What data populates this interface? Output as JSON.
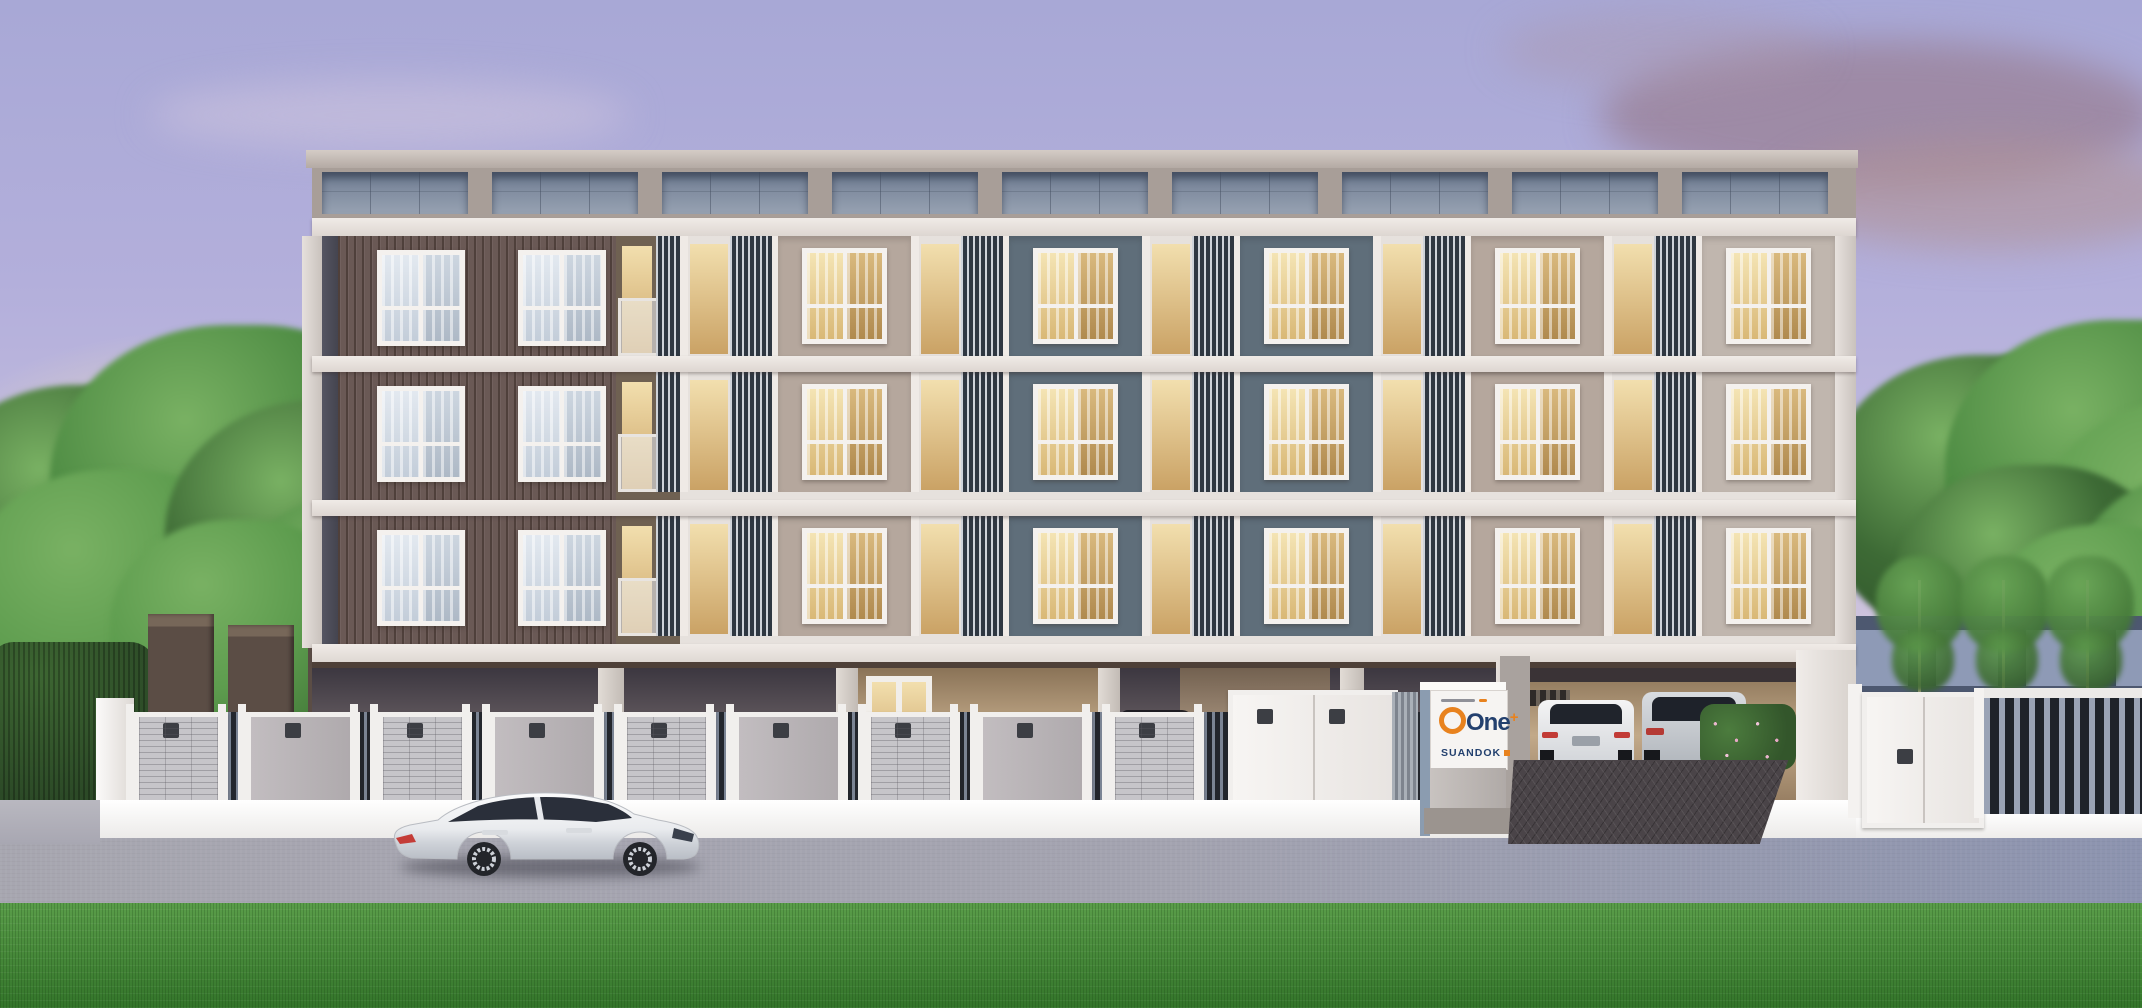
{
  "scene": {
    "title": "dusk-rendering-of-low-rise-condominium",
    "time_of_day": "dusk",
    "sign": {
      "brand": "One",
      "plus": "+",
      "subtitle": "SUANDOK"
    },
    "building": {
      "floors": 3,
      "left_wing_style": "brown ribbed siding",
      "center_bays": 5,
      "windows_lit": true
    },
    "street_vehicle": "white luxury sedan",
    "colors": {
      "sky_top": "#a8a8d6",
      "sky_horizon": "#ecdfd2",
      "sunset_glow": "#f6e7bf",
      "cloud_mauve": "#9b8293",
      "tree_green": "#44823a",
      "grass": "#47923a",
      "wing_brown": "#6a5955",
      "panel_beige": "#b5a79d",
      "panel_slate": "#5f6e7a",
      "panel_greige": "#c0b6ae",
      "beam_white": "#e9e4e0",
      "window_glow": "#ecd39c",
      "parapet_panel": "#8694a6",
      "fence_grey": "#c6c5c9",
      "road_grey": "#a2a2ae",
      "sign_orange": "#e8821e",
      "sign_navy": "#23406e",
      "driveway_paver": "#4a4448"
    }
  },
  "layout": {
    "parapet": {
      "count": 9,
      "x0": 322,
      "pitch": 170,
      "w": 146,
      "y": 172,
      "h": 42
    },
    "floors": [
      {
        "top": 236
      },
      {
        "top": 372
      },
      {
        "top": 516
      }
    ],
    "wing_windows_x": [
      377,
      518
    ],
    "bays": [
      {
        "x": 680,
        "panel": "#b5a79d"
      },
      {
        "x": 911,
        "panel": "#5f6e7a"
      },
      {
        "x": 1142,
        "panel": "#5f6e7a"
      },
      {
        "x": 1373,
        "panel": "#b5a79d"
      },
      {
        "x": 1604,
        "panel": "#c0b6ae"
      }
    ],
    "bay_w": 231,
    "louver_w": 98,
    "fence_gates": [
      {
        "x": 134,
        "w": 84,
        "kind": "grid"
      },
      {
        "x": 246,
        "w": 104,
        "kind": "plain"
      },
      {
        "x": 378,
        "w": 84,
        "kind": "grid"
      },
      {
        "x": 490,
        "w": 104,
        "kind": "plain"
      },
      {
        "x": 622,
        "w": 84,
        "kind": "grid"
      },
      {
        "x": 734,
        "w": 104,
        "kind": "plain"
      },
      {
        "x": 866,
        "w": 84,
        "kind": "grid"
      },
      {
        "x": 978,
        "w": 104,
        "kind": "plain"
      },
      {
        "x": 1110,
        "w": 84,
        "kind": "grid"
      }
    ],
    "rear_gates": {
      "count": 6,
      "x0": 148,
      "pitch": 80,
      "w": 66,
      "ytop0": 614,
      "slope": 11,
      "ybot": 714
    },
    "parked_cars": [
      {
        "x": 455,
        "w": 118,
        "h": 44,
        "c": "#d8dadd"
      },
      {
        "x": 585,
        "w": 112,
        "h": 40,
        "c": "#3a3a40"
      },
      {
        "x": 703,
        "w": 112,
        "h": 40,
        "c": "#6b5a50"
      },
      {
        "x": 828,
        "w": 118,
        "h": 42,
        "c": "#c8ccd2"
      },
      {
        "x": 958,
        "w": 118,
        "h": 42,
        "c": "#26262c"
      },
      {
        "x": 1098,
        "w": 120,
        "h": 46,
        "c": "#34363c"
      },
      {
        "x": 1300,
        "w": 120,
        "h": 46,
        "c": "#1e2024"
      }
    ],
    "trees_left": [
      {
        "x": -80,
        "y": 385,
        "s": 340
      },
      {
        "x": 50,
        "y": 325,
        "s": 385
      },
      {
        "x": -40,
        "y": 470,
        "s": 320
      },
      {
        "x": 165,
        "y": 400,
        "s": 330
      },
      {
        "x": 235,
        "y": 495,
        "s": 250
      },
      {
        "x": 110,
        "y": 520,
        "s": 260
      }
    ],
    "trees_right": [
      {
        "x": 1826,
        "y": 355,
        "s": 330
      },
      {
        "x": 1945,
        "y": 320,
        "s": 365
      },
      {
        "x": 2035,
        "y": 400,
        "s": 330
      },
      {
        "x": 1895,
        "y": 465,
        "s": 280
      },
      {
        "x": 2070,
        "y": 470,
        "s": 300
      },
      {
        "x": 1985,
        "y": 525,
        "s": 240
      }
    ],
    "saplings": [
      {
        "x": 1918
      },
      {
        "x": 2002
      },
      {
        "x": 2086
      }
    ]
  }
}
